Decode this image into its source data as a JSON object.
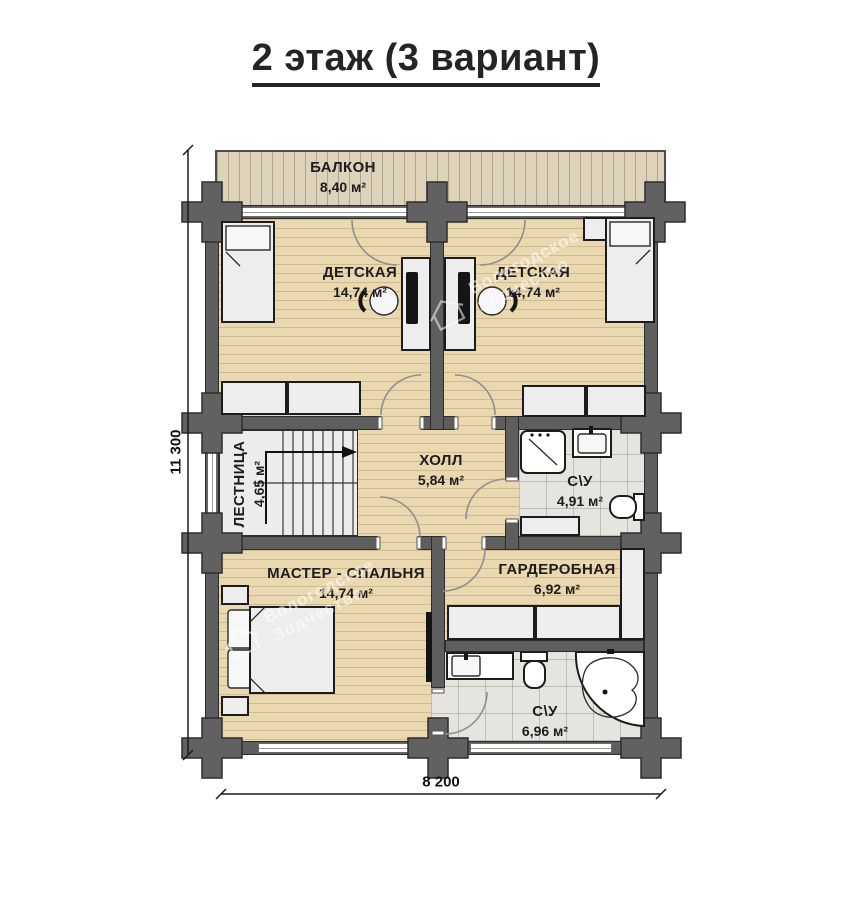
{
  "title": "2 этаж (3 вариант)",
  "dimensions": {
    "height": "11 300",
    "width": "8 200"
  },
  "watermark": {
    "line1": "Вологодское",
    "line2": "Зодчество"
  },
  "rooms": {
    "balcony": {
      "name": "БАЛКОН",
      "area": "8,40 м²"
    },
    "child_left": {
      "name": "ДЕТСКАЯ",
      "area": "14,74 м²"
    },
    "child_right": {
      "name": "ДЕТСКАЯ",
      "area": "14,74 м²"
    },
    "stairs": {
      "name": "ЛЕСТНИЦА",
      "area": "4,65 м²"
    },
    "hall": {
      "name": "ХОЛЛ",
      "area": "5,84 м²"
    },
    "bath_upper": {
      "name": "С\\У",
      "area": "4,91 м²"
    },
    "master": {
      "name": "МАСТЕР - СПАЛЬНЯ",
      "area": "14,74 м²"
    },
    "wardrobe": {
      "name": "ГАРДЕРОБНАЯ",
      "area": "6,92 м²"
    },
    "bath_lower": {
      "name": "С\\У",
      "area": "6,96 м²"
    }
  },
  "colors": {
    "wall": "#5e5e5e",
    "wood_floor": "#ead8b0",
    "balcony_floor": "#ddd2ba",
    "tile_floor": "#e5e4df",
    "furniture_fill": "#ededed",
    "text": "#1d1d1d"
  }
}
